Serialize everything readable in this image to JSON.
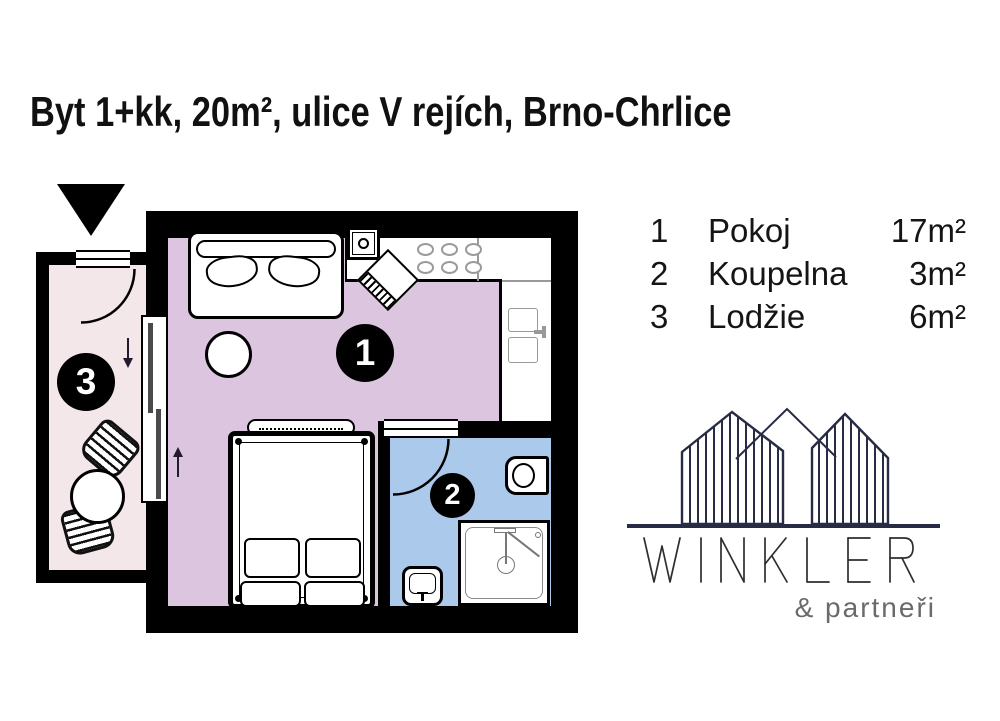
{
  "title": "Byt 1+kk, 20m², ulice V rejích, Brno-Chrlice",
  "legend": {
    "rows": [
      {
        "num": "1",
        "name": "Pokoj",
        "area": "17m²"
      },
      {
        "num": "2",
        "name": "Koupelna",
        "area": "3m²"
      },
      {
        "num": "3",
        "name": "Lodžie",
        "area": "6m²"
      }
    ]
  },
  "floorplan": {
    "badges": {
      "room1": "1",
      "bathroom": "2",
      "loggia": "3"
    },
    "colors": {
      "wall": "#000000",
      "room1_floor": "#dcc5de",
      "bathroom_floor": "#abc9ea",
      "loggia_floor": "#f4e7ea",
      "counter_line": "#999999"
    }
  },
  "logo": {
    "name": "WINKLER",
    "subtitle": "& partneři",
    "brand_color": "#272c44",
    "subtitle_color": "#6a6a6a"
  }
}
